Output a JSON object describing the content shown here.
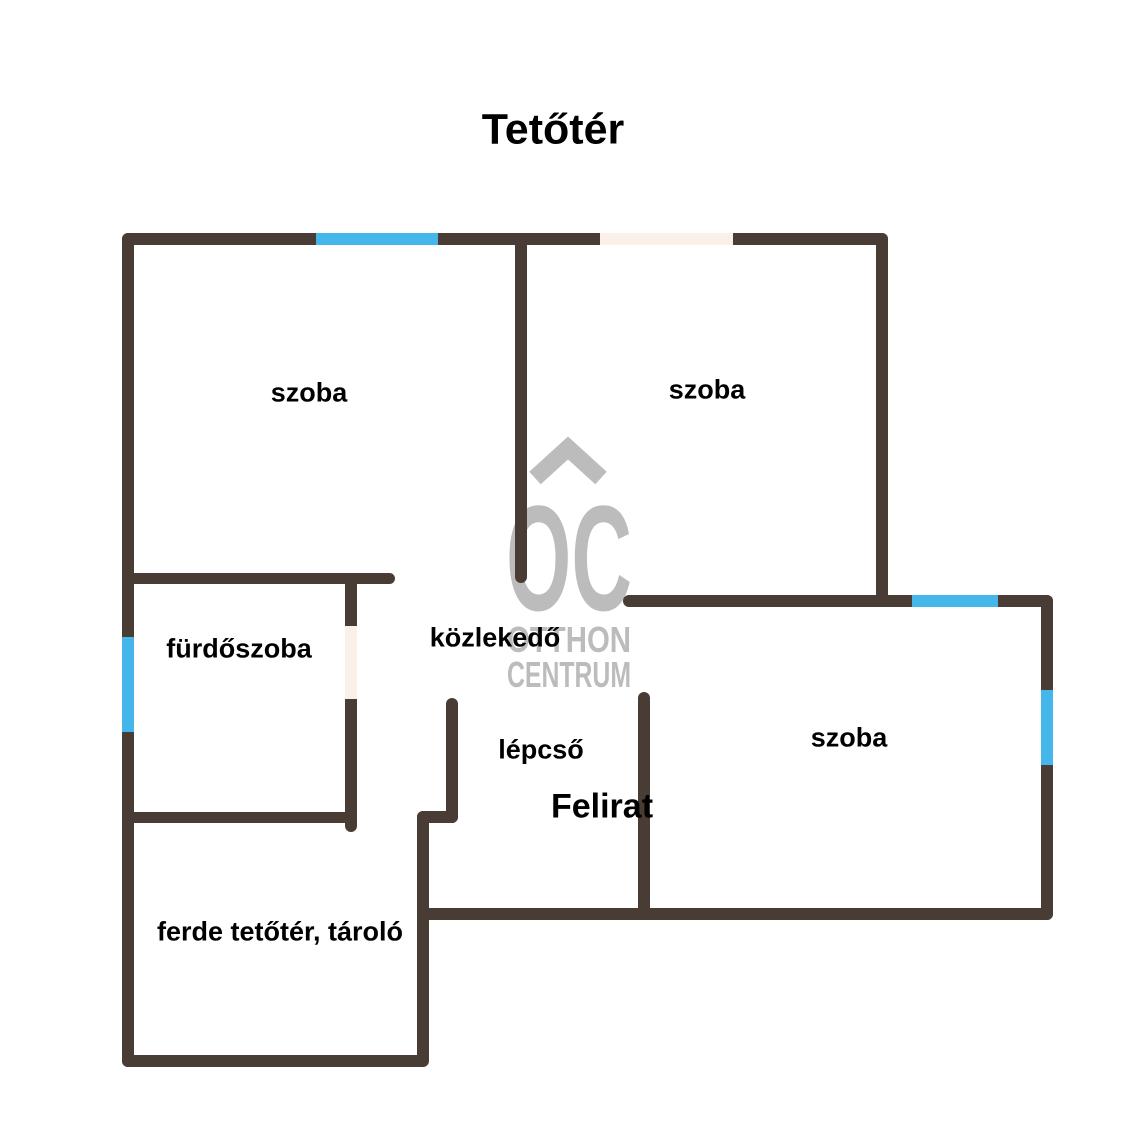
{
  "title": "Tetőtér",
  "colors": {
    "wall": "#483c34",
    "window": "#45b6e9",
    "door": "#fbf0e7",
    "watermark": "#bcbcbc"
  },
  "rooms": {
    "szoba_top_left": {
      "label": "szoba"
    },
    "szoba_top_right": {
      "label": "szoba"
    },
    "szoba_right": {
      "label": "szoba"
    },
    "furdoszoba": {
      "label": "fürdőszoba"
    },
    "kozlekedo": {
      "label": "közlekedő"
    },
    "lepcso": {
      "label": "lépcső"
    },
    "ferde_tetoter": {
      "label": "ferde tetőtér, tároló"
    }
  },
  "annotation": {
    "label": "Felirat"
  },
  "watermark": {
    "monogram": "OC",
    "line1": "OTTHON",
    "line2": "CENTRUM"
  },
  "legend": {
    "window_color_meaning": "window",
    "door_color_meaning": "door opening"
  }
}
